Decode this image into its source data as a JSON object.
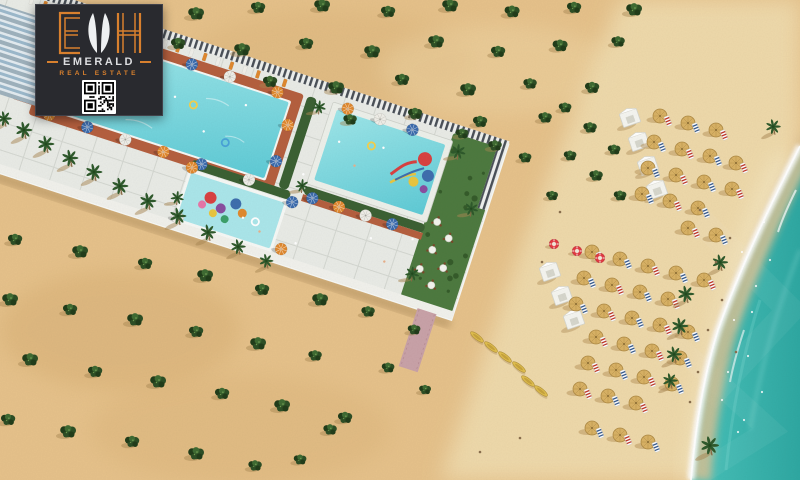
{
  "meta": {
    "title": "Emerald Real Estate beachfront resort aerial render"
  },
  "logo": {
    "initials": "EMH",
    "brand": "EMERALD",
    "tagline": "REAL ESTATE",
    "qr_label": "qr-code"
  },
  "palette": {
    "sand": "#e6c28b",
    "sandDark": "#d2a76c",
    "beach": "#efdcae",
    "wetSand": "#dcc193",
    "sea": "#3fbab2",
    "seaDeep": "#2fa8a2",
    "foam": "#ffffff",
    "pool1": "#9fe6e9",
    "pool2": "#5fcbd6",
    "kidsPool": "#abe6ea",
    "deck": "#b5603f",
    "pavement": "#e9ebe6",
    "grout": "#ced1ca",
    "fenceLight": "#eef0ee",
    "fenceDark": "#4a5058",
    "hedge": "#3c6134",
    "garden": "#4e7a40",
    "palm": "#2f5a2c",
    "bush": "#2e4f26",
    "bushDark": "#223d1b",
    "bushLight": "#3f6b33",
    "shadow": "#a98753",
    "umbBlue": "#3c6cad",
    "umbOrange": "#e0892f",
    "umbWhite": "#efeee8",
    "straw": "#d9b265",
    "strawDark": "#b08c47",
    "cabana": "#f5f5f0",
    "buoy": "#e23b44",
    "kayak": "#e0be4e",
    "pathPink": "#c9a2a8",
    "wall": "#f1f1ec",
    "logoBg": "#292a2f",
    "logoOrange": "#d8802e",
    "logoLight": "#dcdde0",
    "buildingFace": "#e3ebf0",
    "buildingGlass": "#8fb0c5"
  },
  "scene": {
    "description": "Aerial 3D render of a beachfront resort: a diagonal pool deck strip with three pools and a kids water playground, an apartment block top-left, desert sand dotted with shrubs, rows of thatched beach umbrellas, white cabanas, kayaks, lifebuoys and turquoise surf on the right.",
    "bushes": [
      [
        196,
        14,
        1
      ],
      [
        258,
        8,
        0.9
      ],
      [
        322,
        6,
        1
      ],
      [
        388,
        12,
        0.9
      ],
      [
        450,
        6,
        1
      ],
      [
        512,
        12,
        0.95
      ],
      [
        574,
        8,
        0.9
      ],
      [
        634,
        10,
        1
      ],
      [
        178,
        44,
        0.9
      ],
      [
        242,
        50,
        1
      ],
      [
        306,
        44,
        0.9
      ],
      [
        372,
        52,
        1
      ],
      [
        436,
        42,
        1
      ],
      [
        498,
        52,
        0.9
      ],
      [
        560,
        46,
        0.95
      ],
      [
        618,
        42,
        0.85
      ],
      [
        270,
        82,
        0.9
      ],
      [
        336,
        88,
        1
      ],
      [
        402,
        80,
        0.9
      ],
      [
        468,
        90,
        1
      ],
      [
        530,
        84,
        0.85
      ],
      [
        592,
        88,
        0.9
      ],
      [
        350,
        120,
        0.85
      ],
      [
        415,
        114,
        0.9
      ],
      [
        480,
        122,
        0.9
      ],
      [
        545,
        118,
        0.85
      ],
      [
        565,
        108,
        0.8
      ],
      [
        590,
        128,
        0.85
      ],
      [
        614,
        150,
        0.8
      ],
      [
        570,
        156,
        0.8
      ],
      [
        596,
        176,
        0.85
      ],
      [
        620,
        196,
        0.8
      ],
      [
        462,
        134,
        0.8
      ],
      [
        495,
        146,
        0.85
      ],
      [
        525,
        158,
        0.8
      ],
      [
        552,
        196,
        0.75
      ],
      [
        15,
        240,
        0.9
      ],
      [
        80,
        252,
        1
      ],
      [
        145,
        264,
        0.9
      ],
      [
        205,
        276,
        1
      ],
      [
        262,
        290,
        0.9
      ],
      [
        320,
        300,
        1
      ],
      [
        368,
        312,
        0.85
      ],
      [
        10,
        300,
        1
      ],
      [
        70,
        310,
        0.9
      ],
      [
        135,
        320,
        1
      ],
      [
        196,
        332,
        0.9
      ],
      [
        258,
        344,
        1
      ],
      [
        315,
        356,
        0.85
      ],
      [
        30,
        360,
        1
      ],
      [
        95,
        372,
        0.9
      ],
      [
        158,
        382,
        1
      ],
      [
        222,
        394,
        0.9
      ],
      [
        282,
        406,
        1
      ],
      [
        8,
        420,
        0.9
      ],
      [
        68,
        432,
        1
      ],
      [
        132,
        442,
        0.9
      ],
      [
        196,
        454,
        1
      ],
      [
        255,
        466,
        0.85
      ],
      [
        345,
        418,
        0.9
      ],
      [
        388,
        368,
        0.8
      ],
      [
        414,
        330,
        0.8
      ],
      [
        330,
        430,
        0.85
      ],
      [
        300,
        460,
        0.8
      ],
      [
        425,
        390,
        0.75
      ]
    ],
    "resort_palms": [
      [
        6,
        124,
        0.9
      ],
      [
        26,
        136,
        1
      ],
      [
        48,
        150,
        1
      ],
      [
        72,
        164,
        1
      ],
      [
        96,
        178,
        1
      ],
      [
        122,
        192,
        1
      ],
      [
        150,
        207,
        1
      ],
      [
        180,
        222,
        1
      ],
      [
        210,
        238,
        0.95
      ],
      [
        240,
        252,
        0.9
      ],
      [
        268,
        266,
        0.85
      ]
    ],
    "shore_palms": [
      [
        775,
        132,
        0.9
      ],
      [
        722,
        268,
        0.95
      ],
      [
        688,
        300,
        1
      ],
      [
        682,
        332,
        1
      ],
      [
        676,
        360,
        0.95
      ],
      [
        672,
        386,
        0.9
      ],
      [
        712,
        452,
        1.1
      ]
    ],
    "strip_palms": [
      [
        340,
        108,
        0.8
      ],
      [
        478,
        28,
        0.9
      ],
      [
        508,
        78,
        0.85
      ],
      [
        472,
        158,
        0.85
      ],
      [
        225,
        158,
        0.8
      ],
      [
        332,
        28,
        0.8
      ]
    ],
    "pool_umbrellas": [
      [
        76,
        22,
        "b"
      ],
      [
        116,
        22,
        "w"
      ],
      [
        156,
        22,
        "o"
      ],
      [
        196,
        22,
        "b"
      ],
      [
        236,
        22,
        "w"
      ],
      [
        286,
        22,
        "o"
      ],
      [
        76,
        114,
        "o"
      ],
      [
        116,
        114,
        "b"
      ],
      [
        156,
        114,
        "w"
      ],
      [
        196,
        114,
        "o"
      ],
      [
        236,
        114,
        "b"
      ],
      [
        286,
        114,
        "w"
      ],
      [
        62,
        52,
        "b"
      ],
      [
        62,
        88,
        "w"
      ],
      [
        306,
        50,
        "o"
      ],
      [
        306,
        88,
        "b"
      ],
      [
        352,
        112,
        "b"
      ],
      [
        380,
        112,
        "o"
      ],
      [
        408,
        112,
        "w"
      ],
      [
        436,
        112,
        "b"
      ],
      [
        358,
        16,
        "o"
      ],
      [
        392,
        16,
        "w"
      ],
      [
        426,
        16,
        "b"
      ],
      [
        228,
        120,
        "o"
      ],
      [
        334,
        122,
        "b"
      ],
      [
        338,
        170,
        "o"
      ],
      [
        230,
        172,
        "w"
      ]
    ],
    "walkway_loungers": {
      "u0": 24,
      "u1": 300,
      "step": 14,
      "v": 11
    },
    "tables": [
      [
        478,
        96
      ],
      [
        494,
        108
      ],
      [
        482,
        124
      ],
      [
        498,
        138
      ],
      [
        476,
        146
      ],
      [
        492,
        158
      ]
    ],
    "strip_people": [
      [
        150,
        70
      ],
      [
        190,
        58
      ],
      [
        228,
        82
      ],
      [
        120,
        92
      ],
      [
        260,
        44
      ],
      [
        360,
        50
      ],
      [
        382,
        68
      ],
      [
        404,
        42
      ],
      [
        292,
        152
      ],
      [
        312,
        160
      ],
      [
        420,
        132
      ],
      [
        336,
        92
      ],
      [
        440,
        150
      ],
      [
        460,
        120
      ],
      [
        350,
        160
      ]
    ],
    "pool_floats": [
      [
        150,
        75,
        "#e85f8a"
      ],
      [
        210,
        60,
        "#f3d04c"
      ],
      [
        252,
        86,
        "#4aa3d8"
      ],
      [
        392,
        44,
        "#f3d04c"
      ],
      [
        305,
        152,
        "#ffffff"
      ]
    ],
    "umbrellas_north": [
      [
        660,
        116
      ],
      [
        688,
        123
      ],
      [
        716,
        130
      ],
      [
        654,
        142
      ],
      [
        682,
        149
      ],
      [
        710,
        156
      ],
      [
        736,
        163
      ],
      [
        648,
        168
      ],
      [
        676,
        175
      ],
      [
        704,
        182
      ],
      [
        732,
        189
      ],
      [
        642,
        194
      ],
      [
        670,
        201
      ],
      [
        698,
        208
      ],
      [
        688,
        228
      ],
      [
        716,
        235
      ]
    ],
    "umbrellas_south": [
      [
        592,
        252
      ],
      [
        620,
        259
      ],
      [
        648,
        266
      ],
      [
        676,
        273
      ],
      [
        704,
        280
      ],
      [
        584,
        278
      ],
      [
        612,
        285
      ],
      [
        640,
        292
      ],
      [
        668,
        299
      ],
      [
        576,
        304
      ],
      [
        604,
        311
      ],
      [
        632,
        318
      ],
      [
        660,
        325
      ],
      [
        688,
        332
      ],
      [
        596,
        337
      ],
      [
        624,
        344
      ],
      [
        652,
        351
      ],
      [
        680,
        358
      ],
      [
        588,
        363
      ],
      [
        616,
        370
      ],
      [
        644,
        377
      ],
      [
        672,
        384
      ],
      [
        580,
        389
      ],
      [
        608,
        396
      ],
      [
        636,
        403
      ],
      [
        592,
        428
      ],
      [
        620,
        435
      ],
      [
        648,
        442
      ]
    ],
    "cabanas_north": [
      [
        630,
        118
      ],
      [
        639,
        142
      ],
      [
        648,
        166
      ],
      [
        657,
        190
      ]
    ],
    "cabanas_south": [
      [
        550,
        272
      ],
      [
        562,
        296
      ],
      [
        574,
        320
      ]
    ],
    "lifebuoys": [
      [
        554,
        244
      ],
      [
        577,
        251
      ],
      [
        600,
        258
      ]
    ],
    "kayaks": [
      [
        477,
        337,
        38
      ],
      [
        491,
        347,
        38
      ],
      [
        505,
        357,
        38
      ],
      [
        519,
        367,
        38
      ],
      [
        528,
        381,
        38
      ],
      [
        541,
        391,
        38
      ]
    ],
    "beach_people": [
      [
        700,
        210
      ],
      [
        716,
        262
      ],
      [
        722,
        300
      ],
      [
        708,
        330
      ],
      [
        698,
        372
      ],
      [
        730,
        238
      ],
      [
        690,
        402
      ],
      [
        736,
        352
      ],
      [
        560,
        212
      ],
      [
        542,
        262
      ],
      [
        520,
        438
      ],
      [
        480,
        452
      ]
    ],
    "swimmers": [
      [
        742,
        252
      ],
      [
        756,
        286
      ],
      [
        734,
        320
      ],
      [
        748,
        356
      ],
      [
        722,
        400
      ],
      [
        738,
        432
      ],
      [
        764,
        222
      ],
      [
        752,
        312
      ],
      [
        728,
        372
      ],
      [
        762,
        392
      ],
      [
        770,
        260
      ],
      [
        744,
        420
      ]
    ]
  }
}
